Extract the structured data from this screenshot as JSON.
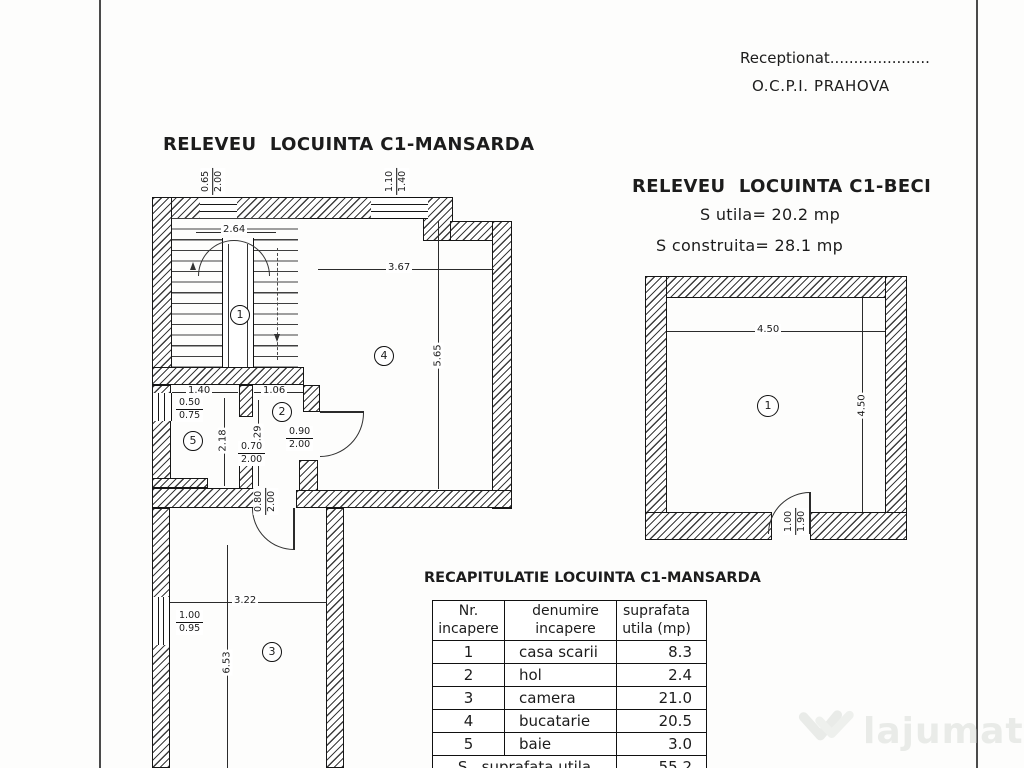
{
  "header": {
    "receptionat": "Receptionat.....................",
    "office": "O.C.P.I. PRAHOVA"
  },
  "mansarda": {
    "title": "RELEVEU  LOCUINTA C1-MANSARDA",
    "room_labels": {
      "r1": "1",
      "r2": "2",
      "r3": "3",
      "r4": "4",
      "r5": "5"
    },
    "dims": {
      "win_top_left_num": "0.65",
      "win_top_left_den": "2.00",
      "win_top_right_num": "1.10",
      "win_top_right_den": "1.40",
      "stair_width": "2.64",
      "room4_width": "3.67",
      "room4_height": "5.65",
      "room5_width": "1.40",
      "room5_height": "2.18",
      "win_left_num": "0.50",
      "win_left_den": "0.75",
      "hol_width": "1.06",
      "hol_height": "2.29",
      "door_r5_num": "0.70",
      "door_r5_den": "2.00",
      "door_r4_num": "0.90",
      "door_r4_den": "2.00",
      "door_r3_num": "0.80",
      "door_r3_den": "2.00",
      "room3_width": "3.22",
      "room3_height": "6.53",
      "win_r3_num": "1.00",
      "win_r3_den": "0.95"
    }
  },
  "beci": {
    "title": "RELEVEU  LOCUINTA C1-BECI",
    "s_utila": "S utila= 20.2 mp",
    "s_construita": "S construita= 28.1 mp",
    "room_label": "1",
    "dim_width": "4.50",
    "dim_height": "4.50",
    "door_num": "1.00",
    "door_den": "1.90"
  },
  "recap": {
    "title": "RECAPITULATIE LOCUINTA C1-MANSARDA",
    "col_headers": [
      "Nr.\nincapere",
      "denumire\nincapere",
      "suprafata\nutila (mp)"
    ],
    "rows": [
      {
        "nr": "1",
        "name": "casa scarii",
        "area": "8.3"
      },
      {
        "nr": "2",
        "name": "hol",
        "area": "2.4"
      },
      {
        "nr": "3",
        "name": "camera",
        "area": "21.0"
      },
      {
        "nr": "4",
        "name": "bucatarie",
        "area": "20.5"
      },
      {
        "nr": "5",
        "name": "baie",
        "area": "3.0"
      }
    ],
    "total_label": "S   suprafata utila",
    "total_value": "55.2"
  },
  "watermark": {
    "name": "lajumate",
    "tld": ".ro"
  }
}
